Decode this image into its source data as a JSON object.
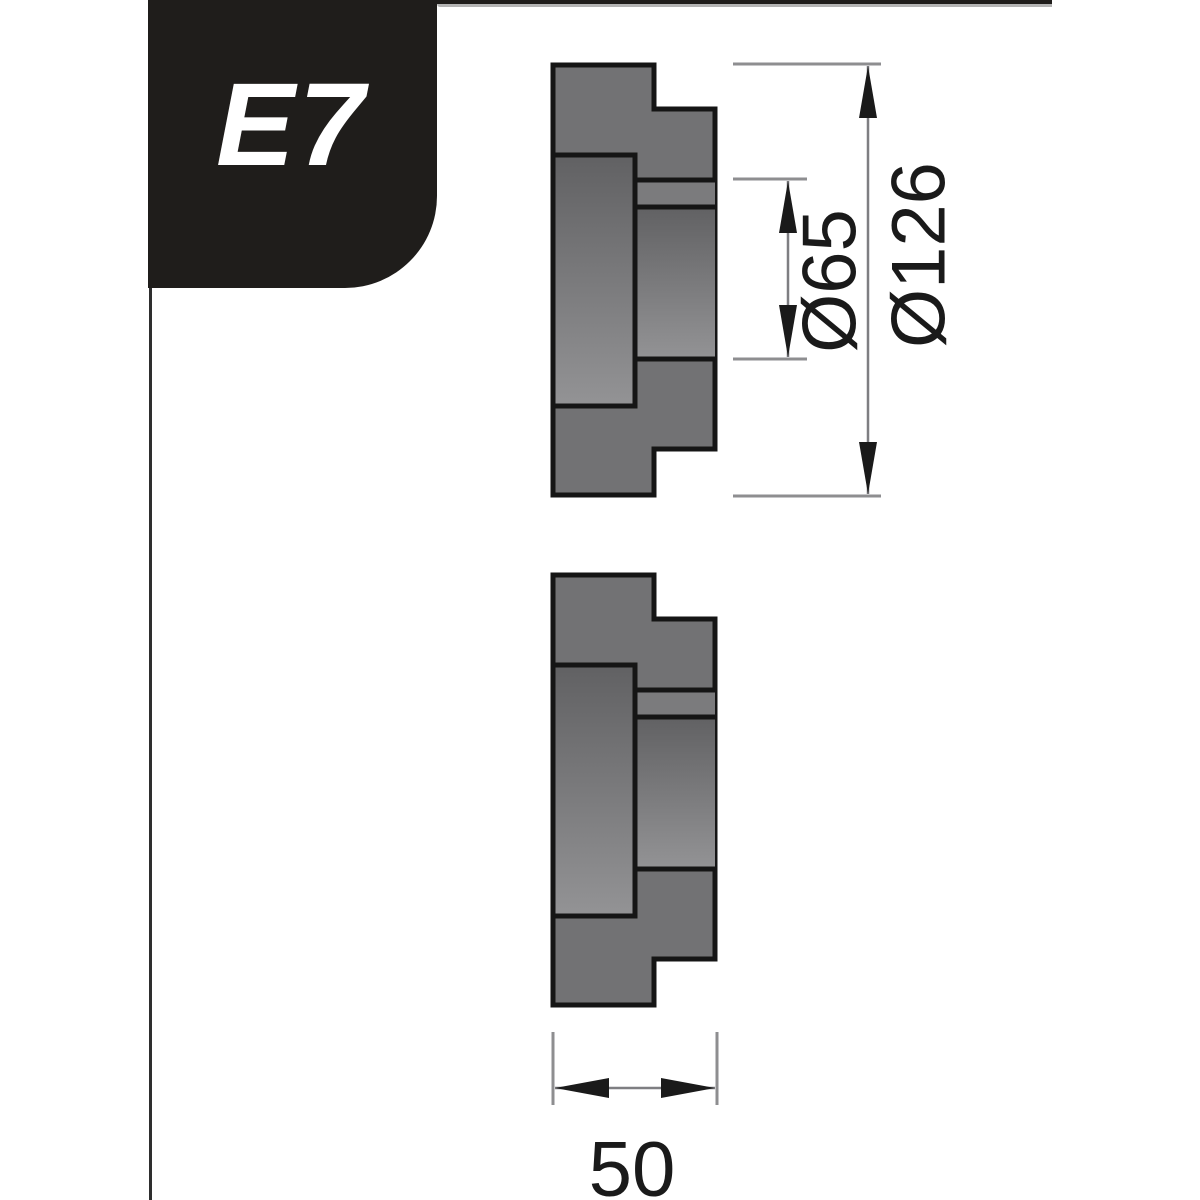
{
  "tab": {
    "label": "E7"
  },
  "drawing": {
    "labels": {
      "bore_diameter": "Ø65",
      "outer_diameter": "Ø126",
      "width": "50"
    }
  },
  "colors": {
    "page_background": "#ffffff",
    "tab_background": "#1f1d1b",
    "tab_text": "#ffffff",
    "top_rule": "#1f1d1b",
    "top_rule_shadow": "#b4b4b4",
    "left_rule": "#2e2e2e",
    "body": "#727274",
    "body_shadow_top": "#616163",
    "body_highlight_bottom": "#939395",
    "groove": "#7b7b7d",
    "outline": "#151515",
    "extension_line": "#8e8e90",
    "dimension_line": "#7e7e82",
    "arrow": "#1a1a1a",
    "text": "#1a1a1a"
  }
}
